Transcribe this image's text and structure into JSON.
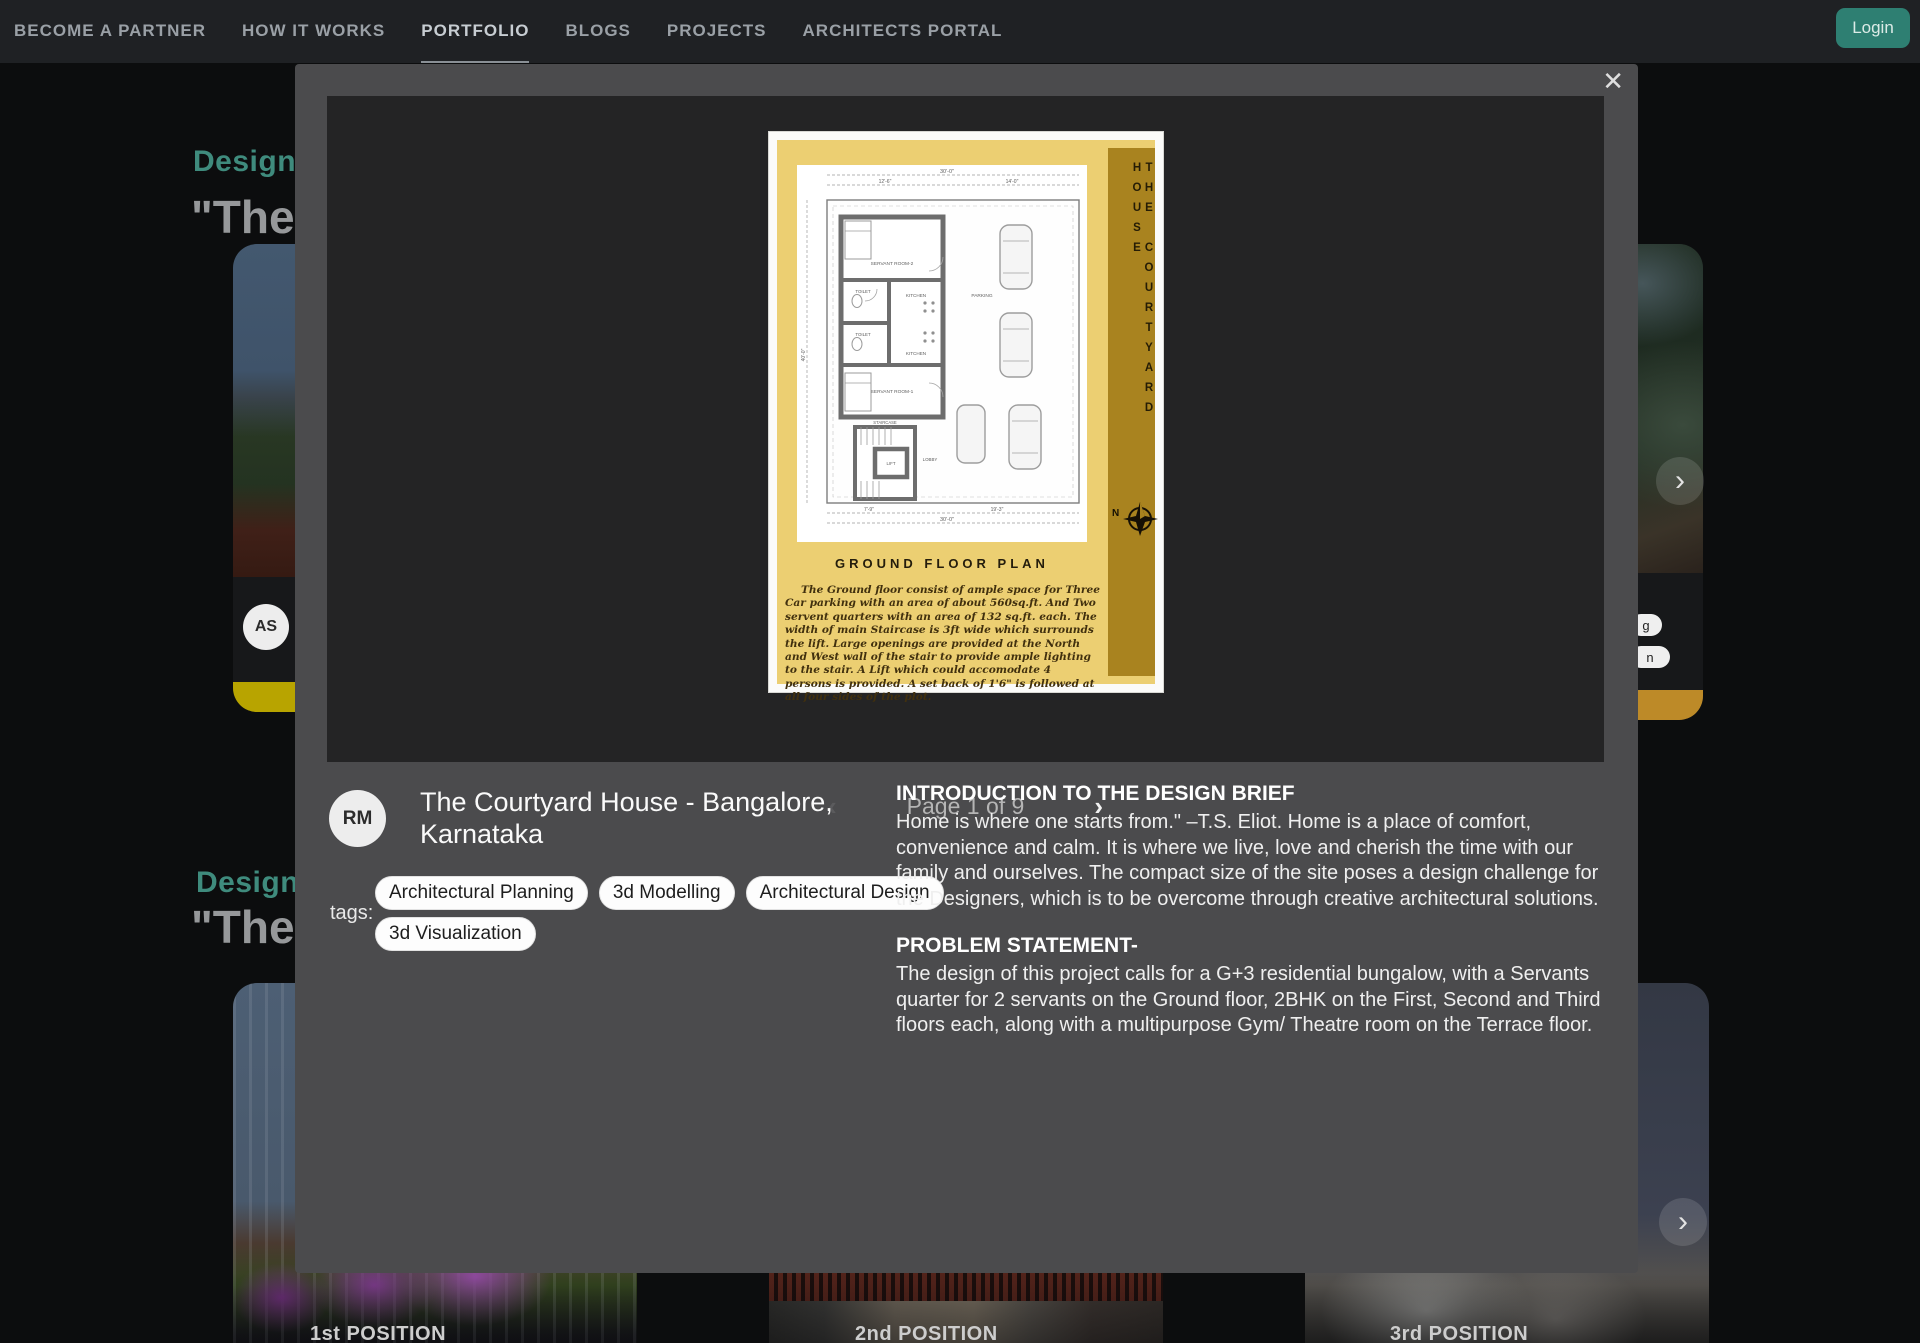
{
  "nav": {
    "items": [
      "BECOME A PARTNER",
      "HOW IT WORKS",
      "PORTFOLIO",
      "BLOGS",
      "PROJECTS",
      "ARCHITECTS PORTAL"
    ],
    "active_item": "PORTFOLIO",
    "login_label": "Login"
  },
  "background": {
    "sections": [
      {
        "eyebrow": "Designs",
        "title_fragment": "\"The"
      },
      {
        "eyebrow": "Designs",
        "title_fragment": "\"The"
      }
    ],
    "row1": {
      "left_card_avatar": "AS",
      "partial_tag_fragments": [
        "g",
        "n"
      ],
      "accent_yellow": "#b8a400",
      "accent_amber": "#bd8a28"
    },
    "row2_positions": [
      "1st POSITION",
      "2nd POSITION",
      "3rd POSITION"
    ],
    "carousel_chevron": "›"
  },
  "modal": {
    "close_glyph": "✕",
    "pager": {
      "prev_glyph": "‹",
      "next_glyph": "›",
      "status": "Page 1 of 9"
    },
    "plan": {
      "vertical_title": "THE COURTYARD HOUSE",
      "north_label": "N",
      "caption": "GROUND FLOOR PLAN",
      "description": "The Ground floor consist of ample space for Three Car parking  with an area of about 560sq.ft.  And Two servent quarters with an area of 132 sq.ft. each. The width of main Staircase is 3ft wide which surrounds the lift. Large openings are provided at the North and West wall of the stair to provide ample lighting to the stair. A Lift which could accomodate 4 persons is provided. A set back of 1'6\" is followed at all  four sides of the plot.",
      "rooms": {
        "servant2": "SERVANT ROOM-2",
        "kitchen1": "KITCHEN",
        "toilet1": "TOILET",
        "toilet2": "TOILET",
        "kitchen2": "KITCHEN",
        "servant1": "SERVANT ROOM-1",
        "stair": "STAIRCASE",
        "lift": "LIFT",
        "lobby": "LOBBY",
        "parking": "PARKING"
      },
      "dims": {
        "top": "30'-0\"",
        "top_a": "12'-6\"",
        "top_b": "14'-0\"",
        "left": "40'-0\"",
        "bottom_a": "7'-9\"",
        "bottom_b": "19'-3\"",
        "bottom": "30'-0\""
      }
    },
    "project": {
      "avatar": "RM",
      "title": "The Courtyard House - Bangalore, Karnataka",
      "tags_label": "tags:",
      "tags": [
        "Architectural Planning",
        "3d Modelling",
        "Architectural Design",
        "3d Visualization"
      ]
    },
    "brief": {
      "intro_heading": "INTRODUCTION TO THE DESIGN BRIEF",
      "intro_text": "Home is where one starts from.\" –T.S. Eliot. Home is a place of comfort, convenience and calm. It is where we live, love and cherish the time with our family and ourselves. The compact size of the site poses a design challenge for the Designers, which is to be overcome through creative architectural solutions.",
      "problem_heading": "PROBLEM STATEMENT-",
      "problem_text": "The design of this project calls for a G+3 residential bungalow, with a Servants quarter for 2 servants on the Ground floor, 2BHK on the First, Second and Third floors each, along with a multipurpose Gym/ Theatre room on the Terrace floor."
    }
  }
}
